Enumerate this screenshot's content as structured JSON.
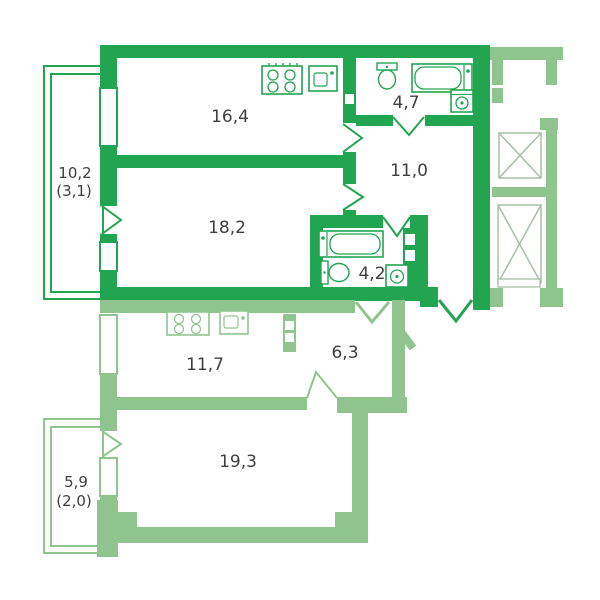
{
  "type": "apartment-floor-plan",
  "colors": {
    "unit_a_walls": "#22a550",
    "unit_b_walls": "#90c48f",
    "core_walls": "#90c48f",
    "elevator_outline": "#a9bfa9",
    "label_text": "#3f3f3f",
    "background": "#ffffff"
  },
  "units": {
    "unit_a": {
      "style": "bold-green",
      "rooms": {
        "kitchen": {
          "area": "16,4"
        },
        "bathroom": {
          "area": "4,7"
        },
        "hallway": {
          "area": "11,0"
        },
        "living_room": {
          "area": "18,2"
        },
        "bathroom2": {
          "area": "4,2"
        },
        "balcony": {
          "area": "10,2",
          "area_reduced": "(3,1)"
        }
      }
    },
    "unit_b": {
      "style": "light-green",
      "rooms": {
        "kitchen": {
          "area": "11,7"
        },
        "hallway": {
          "area": "6,3"
        },
        "living_room": {
          "area": "19,3"
        },
        "balcony": {
          "area": "5,9",
          "area_reduced": "(2,0)"
        }
      }
    }
  },
  "fixtures": [
    "stove-icon",
    "sink-icon",
    "toilet-icon",
    "bathtub-icon",
    "washing-machine-icon",
    "elevator-shaft",
    "stair-landing"
  ]
}
